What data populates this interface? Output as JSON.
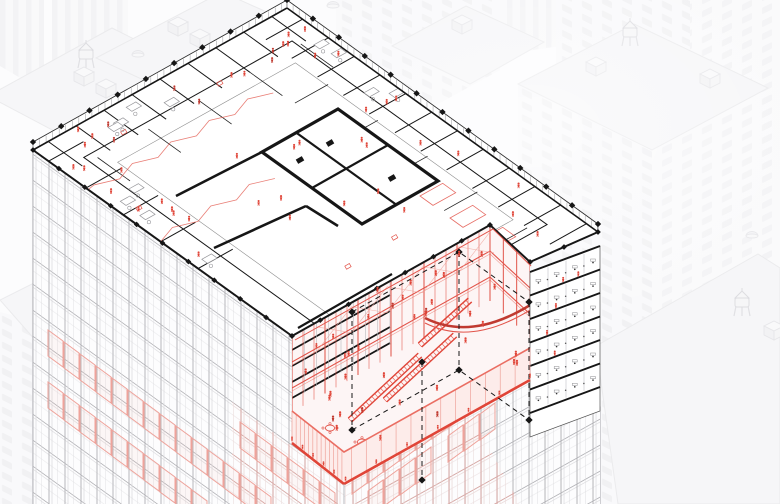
{
  "scene_type": "axonometric-architectural-cutaway-illustration",
  "palette": {
    "paper": "#fbfbfc",
    "ink": "#161616",
    "wall_gray": "#8f8f94",
    "grid_line": "#b4b4b8",
    "grid_line_light": "#dadadd",
    "red": "#e2544a",
    "red_bright": "#e04538",
    "red_dark": "#c03a30",
    "red_light": "#efa39b",
    "red_faint": "#f9dcd8",
    "red_wash": "rgba(228,90,80,0.06)",
    "bg_fill": "#f3f3f5",
    "bg_fill_light": "#f7f7f9",
    "bg_line": "#e2e2e5",
    "bg_window": "#eaeaed",
    "fog": "#ffffff"
  },
  "tower": {
    "cut_quad": {
      "W": [
        33,
        150
      ],
      "N": [
        287,
        8
      ],
      "E": [
        598,
        232
      ],
      "S": [
        344,
        374
      ]
    },
    "plan_boundary": [
      [
        33,
        150
      ],
      [
        287,
        8
      ],
      [
        598,
        232
      ],
      [
        530,
        262
      ],
      [
        490,
        225
      ],
      [
        292,
        336
      ]
    ],
    "red_zone": [
      [
        292,
        336
      ],
      [
        490,
        225
      ],
      [
        530,
        262
      ],
      [
        530,
        380
      ],
      [
        344,
        484
      ],
      [
        292,
        443
      ]
    ],
    "sw_facade": [
      [
        33,
        150
      ],
      [
        292,
        336
      ],
      [
        292,
        443
      ],
      [
        344,
        484
      ],
      [
        344,
        504
      ],
      [
        33,
        504
      ]
    ],
    "se_facade": [
      [
        344,
        484
      ],
      [
        530,
        380
      ],
      [
        530,
        433
      ],
      [
        600,
        407
      ],
      [
        600,
        504
      ],
      [
        344,
        504
      ]
    ],
    "section_stack": {
      "quad": [
        [
          530,
          272
        ],
        [
          600,
          246
        ],
        [
          600,
          411
        ],
        [
          530,
          437
        ]
      ],
      "slab_count": 7,
      "slab_step": 23.5
    },
    "core": [
      [
        262,
        152
      ],
      [
        338,
        109
      ],
      [
        438,
        181
      ],
      [
        362,
        224
      ]
    ],
    "dashed_box": {
      "top": [
        [
          352,
          312
        ],
        [
          459,
          252
        ],
        [
          529,
          302
        ],
        [
          422,
          362
        ]
      ],
      "drop": 118
    },
    "atrium_levels": [
      26,
      52
    ],
    "fringe": {
      "upper": [
        [
          292,
          411
        ],
        [
          344,
          452
        ],
        [
          530,
          348
        ]
      ],
      "lower": [
        [
          292,
          443
        ],
        [
          344,
          484
        ],
        [
          530,
          380
        ]
      ]
    },
    "floor_spacing": 26,
    "mullion_spacing": 16,
    "perimeter_column_spacing": 30,
    "sw_red_panels": [
      [
        48,
        330
      ],
      [
        64,
        342
      ],
      [
        80,
        354
      ],
      [
        96,
        366
      ],
      [
        112,
        378
      ],
      [
        128,
        390
      ],
      [
        48,
        382
      ],
      [
        64,
        394
      ],
      [
        80,
        406
      ],
      [
        96,
        418
      ],
      [
        112,
        430
      ],
      [
        128,
        442
      ],
      [
        144,
        402
      ],
      [
        160,
        414
      ],
      [
        176,
        426
      ],
      [
        192,
        438
      ],
      [
        144,
        454
      ],
      [
        160,
        466
      ],
      [
        176,
        478
      ],
      [
        192,
        490
      ],
      [
        208,
        450
      ],
      [
        224,
        462
      ],
      [
        240,
        474
      ],
      [
        256,
        434
      ],
      [
        272,
        446
      ],
      [
        288,
        458
      ],
      [
        304,
        470
      ],
      [
        320,
        482
      ],
      [
        240,
        422
      ],
      [
        256,
        486
      ]
    ],
    "se_red_panels": [
      [
        352,
        468
      ],
      [
        368,
        457
      ],
      [
        384,
        446
      ],
      [
        400,
        435
      ],
      [
        416,
        424
      ],
      [
        432,
        413
      ],
      [
        368,
        491
      ],
      [
        384,
        480
      ],
      [
        400,
        469
      ],
      [
        416,
        458
      ],
      [
        448,
        402
      ],
      [
        464,
        391
      ],
      [
        480,
        380
      ],
      [
        496,
        369
      ],
      [
        352,
        434
      ],
      [
        368,
        423
      ],
      [
        448,
        436
      ],
      [
        464,
        425
      ],
      [
        480,
        414
      ],
      [
        384,
        412
      ]
    ]
  },
  "background": {
    "striped_slabs": [
      [
        [
          52,
          0
        ],
        [
          128,
          0
        ],
        [
          128,
          140
        ],
        [
          52,
          96
        ]
      ],
      [
        [
          0,
          0
        ],
        [
          44,
          0
        ],
        [
          44,
          92
        ],
        [
          0,
          66
        ]
      ],
      [
        [
          340,
          0
        ],
        [
          560,
          0
        ],
        [
          560,
          46
        ],
        [
          440,
          64
        ]
      ]
    ],
    "window_faces_left": [
      [
        [
          336,
          0
        ],
        [
          500,
          0
        ],
        [
          500,
          70
        ],
        [
          336,
          160
        ]
      ],
      [
        [
          556,
          0
        ],
        [
          690,
          0
        ],
        [
          690,
          130
        ],
        [
          556,
          190
        ]
      ],
      [
        [
          518,
          84
        ],
        [
          652,
          150
        ],
        [
          652,
          504
        ],
        [
          518,
          504
        ]
      ],
      [
        [
          128,
          170
        ],
        [
          252,
          98
        ],
        [
          252,
          215
        ],
        [
          128,
          292
        ]
      ],
      [
        [
          0,
          312
        ],
        [
          96,
          336
        ],
        [
          96,
          504
        ],
        [
          0,
          504
        ]
      ]
    ],
    "window_faces_right": [
      [
        [
          690,
          0
        ],
        [
          780,
          0
        ],
        [
          780,
          130
        ],
        [
          690,
          130
        ]
      ],
      [
        [
          652,
          150
        ],
        [
          768,
          88
        ],
        [
          780,
          96
        ],
        [
          780,
          504
        ],
        [
          652,
          504
        ]
      ]
    ],
    "roofs": [
      [
        [
          -12,
          96
        ],
        [
          112,
          28
        ],
        [
          252,
          98
        ],
        [
          128,
          170
        ]
      ],
      [
        [
          96,
          58
        ],
        [
          222,
          -8
        ],
        [
          356,
          52
        ],
        [
          230,
          120
        ]
      ],
      [
        [
          392,
          46
        ],
        [
          466,
          6
        ],
        [
          544,
          42
        ],
        [
          470,
          84
        ]
      ],
      [
        [
          518,
          84
        ],
        [
          634,
          24
        ],
        [
          768,
          88
        ],
        [
          652,
          150
        ]
      ],
      [
        [
          676,
          332
        ],
        [
          748,
          294
        ],
        [
          780,
          312
        ],
        [
          780,
          368
        ],
        [
          712,
          400
        ]
      ],
      [
        [
          596,
          346
        ],
        [
          758,
          254
        ],
        [
          780,
          268
        ],
        [
          780,
          504
        ],
        [
          618,
          504
        ]
      ],
      [
        [
          0,
          300
        ],
        [
          52,
          274
        ],
        [
          98,
          322
        ],
        [
          44,
          350
        ]
      ]
    ],
    "water_towers": [
      [
        86,
        52
      ],
      [
        630,
        30
      ],
      [
        742,
        300
      ]
    ],
    "hvac_units": [
      [
        74,
        72
      ],
      [
        96,
        84
      ],
      [
        168,
        22
      ],
      [
        190,
        34
      ],
      [
        452,
        20
      ],
      [
        586,
        62
      ],
      [
        700,
        74
      ],
      [
        764,
        326
      ]
    ],
    "dome_vents": [
      [
        138,
        55
      ],
      [
        333,
        6
      ],
      [
        420,
        152
      ],
      [
        752,
        236
      ]
    ]
  },
  "figures": {
    "plan": 46,
    "atrium": 30,
    "mezzanine": 8,
    "section_stack": 5,
    "fringe": 12,
    "seed": 13
  },
  "furniture": {
    "plan_desks": 12,
    "atrium_tables": 6
  }
}
